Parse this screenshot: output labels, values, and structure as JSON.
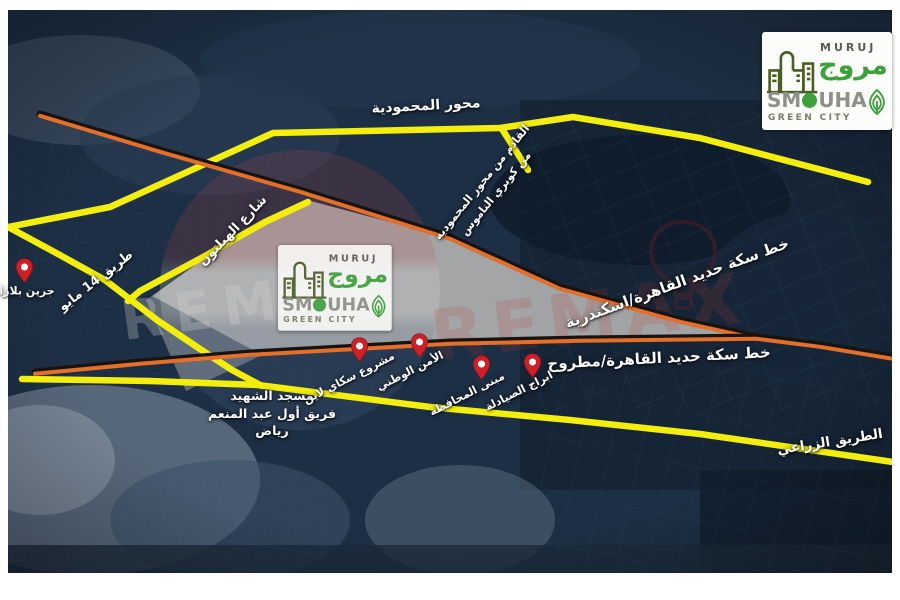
{
  "brand": {
    "name_en": "MURUJ",
    "name_ar": "مروج",
    "district_prefix": "SM",
    "district_o": "O",
    "district_suffix": "UHA",
    "tagline": "GREEN CITY"
  },
  "watermark": {
    "text_left": "REMAX",
    "text_right": "REMAX"
  },
  "roads": {
    "mahmoudeya_axis": "محور المحمودية",
    "ramp_line1": "القادم من محور المحموديه",
    "ramp_line2": "من كوبري الناموس",
    "hilton_street": "شارع الهيلتون",
    "may14_road": "طريق 14 مايو",
    "agricultural_road": "الطريق الزراعي"
  },
  "railways": {
    "cairo_alexandria": "خط سكة حديد القاهرة/اسكندرية",
    "cairo_matrouh": "خط سكة حديد القاهرة/مطروح"
  },
  "landmarks": {
    "mosque_line1": "مسجد الشهيد",
    "mosque_line2": "فريق أول عبد المنعم",
    "mosque_line3": "رياض"
  },
  "pins": [
    {
      "label": "جرين بلازا"
    },
    {
      "label": "مشروع سكاي لاين"
    },
    {
      "label": "الأمن الوطني"
    },
    {
      "label": "مبنى المحافظة"
    },
    {
      "label": "ابراج الصيادلة"
    }
  ],
  "colors": {
    "road_yellow": "#f3ee0e",
    "railway_orange": "#e2702a",
    "railway_dark": "#191310",
    "pin_red": "#ce2027",
    "land_fill": "#c9c6c3",
    "brand_green": "#3da13b",
    "brand_building_green": "#4a5d23",
    "map_base_navy": "#1d2f44"
  }
}
